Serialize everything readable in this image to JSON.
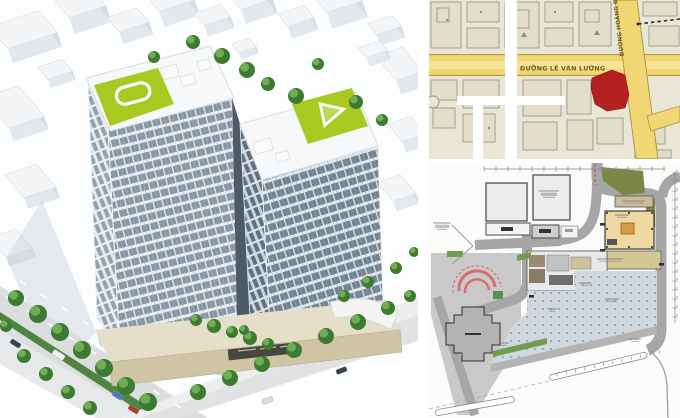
{
  "map": {
    "label_horizontal_road": "ĐƯỜNG LÊ VĂN LƯƠNG",
    "label_diagonal_road": "ĐƯỜNG HOÀNG ĐẠO",
    "colors": {
      "background": "#eae6d6",
      "block_fill": "#e2decb",
      "block_line": "#918f80",
      "road": "#f1d773",
      "road_edge": "#a8933a",
      "plot": "#b22020",
      "grid_overlay": "#ffffff"
    }
  },
  "site_plan": {
    "colors": {
      "paper": "#fbfbfa",
      "road": "#a6a6a6",
      "court": "#c9c9c9",
      "tower_footprint": "#eed9a2",
      "tower_core": "#da9c3f",
      "podium": "#d3c794",
      "plaza": "#cfd8df",
      "green": "#6f9c4f",
      "olive": "#7b8747",
      "ramp": "#d96b6b",
      "cross_building": "#b3b3b3"
    }
  },
  "render": {
    "colors": {
      "glass": "#8696a4",
      "roof_green": "#a9c922",
      "tree": "#3f7a33",
      "podium_face": "#cfc4a4",
      "street": "#dbdddf",
      "median_green": "#4f8540"
    }
  }
}
